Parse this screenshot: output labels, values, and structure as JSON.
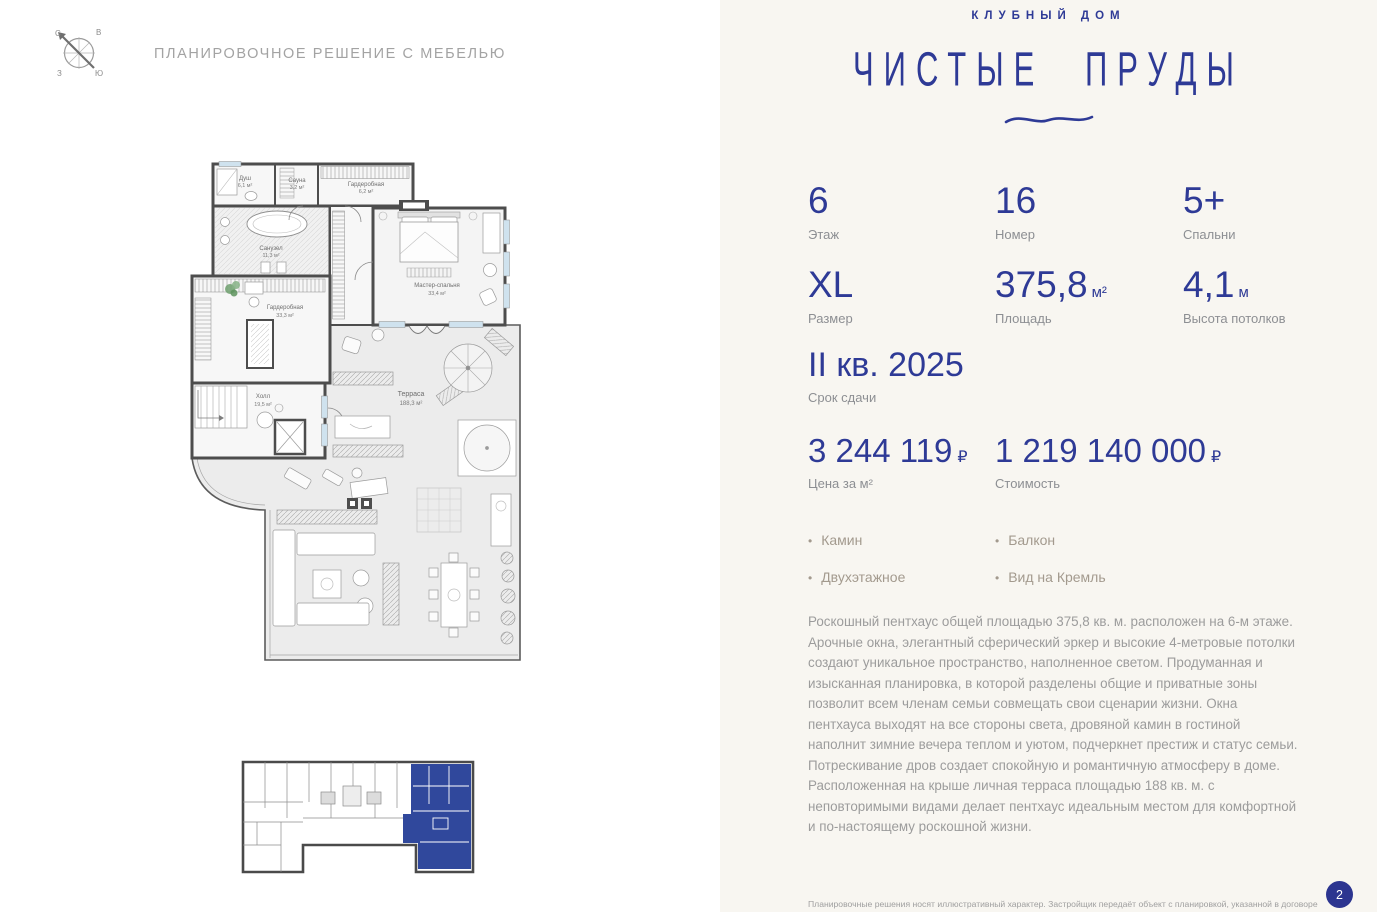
{
  "header": {
    "title": "ПЛАНИРОВОЧНОЕ РЕШЕНИЕ С МЕБЕЛЬЮ",
    "compass": {
      "n": "С",
      "e": "В",
      "w": "З",
      "s": "Ю"
    }
  },
  "brand": {
    "kicker": "КЛУБНЫЙ ДОМ",
    "name": "ЧИСТЫЕ ПРУДЫ"
  },
  "stats": [
    {
      "value": "6",
      "unit": "",
      "label": "Этаж"
    },
    {
      "value": "16",
      "unit": "",
      "label": "Номер"
    },
    {
      "value": "5+",
      "unit": "",
      "label": "Спальни"
    },
    {
      "value": "XL",
      "unit": "",
      "label": "Размер"
    },
    {
      "value": "375,8",
      "unit": "м²",
      "label": "Площадь"
    },
    {
      "value": "4,1",
      "unit": "м",
      "label": "Высота потолков"
    }
  ],
  "deadline": {
    "value": "II кв. 2025",
    "label": "Срок сдачи"
  },
  "prices": [
    {
      "value": "3 244 119",
      "currency": "₽",
      "label": "Цена за м²"
    },
    {
      "value": "1 219 140 000",
      "currency": "₽",
      "label": "Стоимость"
    }
  ],
  "features": [
    {
      "label": "Камин"
    },
    {
      "label": "Двухэтажное"
    },
    {
      "label": "Балкон"
    },
    {
      "label": "Вид на Кремль"
    }
  ],
  "description": "Роскошный пентхаус общей площадью 375,8 кв. м. расположен на 6-м этаже. Арочные окна, элегантный сферический эркер и высокие 4-метровые потолки создают уникальное пространство, наполненное светом.  Продуманная и изысканная планировка, в которой разделены общие и приватные зоны позволит всем членам семьи совмещать свои сценарии жизни. Окна пентхауса выходят на все стороны света, дровяной камин в гостиной наполнит зимние вечера теплом и уютом, подчеркнет престиж и статус семьи. Потрескивание дров  создает спокойную и романтичную атмосферу в доме. Расположенная на крыше личная терраса площадью 188 кв. м. с неповторимыми видами делает пентхаус идеальным местом для комфортной и по-настоящему роскошной жизни.",
  "footer": {
    "disclaimer": "Планировочные решения носят иллюстративный характер. Застройщик передаёт объект с планировкой, указанной в договоре",
    "page": "2"
  },
  "floor_plan": {
    "rooms": [
      {
        "name": "Душ",
        "area": "6,1 м²"
      },
      {
        "name": "Сауна",
        "area": "3,2 м²"
      },
      {
        "name": "Гардеробная",
        "area": "6,2 м²"
      },
      {
        "name": "Санузел",
        "area": "11,3 м²"
      },
      {
        "name": "Мастер-спальня",
        "area": "33,4 м²"
      },
      {
        "name": "Гардеробная",
        "area": "33,3 м²"
      },
      {
        "name": "Холл",
        "area": "19,5 м²"
      },
      {
        "name": "Терраса",
        "area": "188,3 м²"
      }
    ]
  },
  "colors": {
    "accent": "#2e3a96",
    "highlight": "#30489c",
    "window": "#cfe2ee",
    "wall": "#4d4d4d"
  }
}
